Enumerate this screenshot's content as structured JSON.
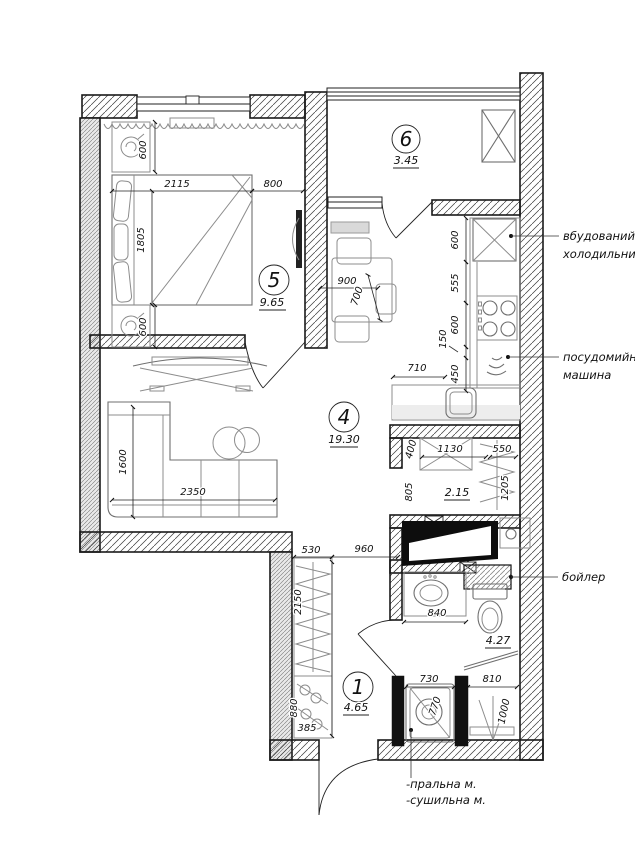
{
  "rooms": {
    "bedroom": {
      "number": "5",
      "area": "9.65"
    },
    "balcony": {
      "number": "6",
      "area": "3.45"
    },
    "living_kitchen": {
      "number": "4",
      "area": "19.30"
    },
    "hallway": {
      "number": "1",
      "area": "4.65"
    },
    "storage": {
      "area": "2.15"
    },
    "bathroom": {
      "area": "4.27"
    }
  },
  "labels": {
    "fridge": [
      "вбудований",
      "холодильник"
    ],
    "dishwasher": [
      "посудомийна",
      "машина"
    ],
    "boiler": "бойлер",
    "washing_machine": "-пральна м.",
    "dryer": "-сушильна м."
  },
  "dims": {
    "bedroom_nightstand_top": "600",
    "bedroom_bed_width": "2115",
    "bedroom_bed_to_wall": "800",
    "bedroom_bed_length": "1805",
    "bedroom_nightstand_bottom": "600",
    "kitchen_fridge": "600",
    "kitchen_counter": "555",
    "kitchen_cooktop": "600",
    "kitchen_filler": "150",
    "kitchen_sink": "450",
    "kitchen_return": "710",
    "table_width": "900",
    "table_depth": "700",
    "sofa_depth": "1600",
    "sofa_length": "2350",
    "wardrobe_width": "530",
    "corridor_width": "960",
    "wardrobe_length": "2150",
    "shoe_cabinet": "880",
    "shoe_cabinet_depth": "385",
    "storage_niche": "400",
    "storage_cabinet": "1130",
    "storage_hanging": "550",
    "storage_depth_left": "805",
    "storage_depth_right": "1205",
    "vanity_width": "840",
    "washer_width": "730",
    "washer_depth": "770",
    "shower_width": "810",
    "shower_depth": "1000"
  }
}
